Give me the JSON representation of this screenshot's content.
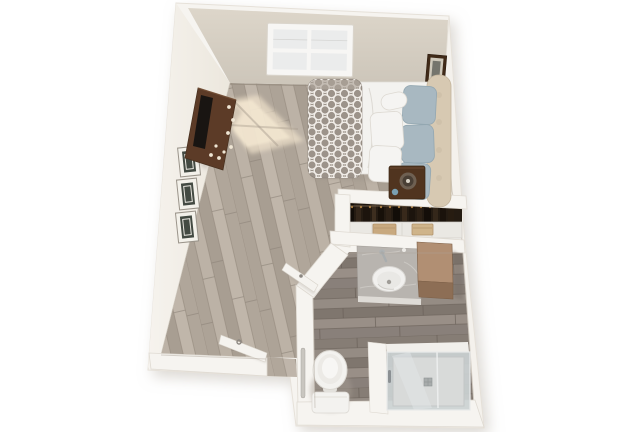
{
  "meta": {
    "kind": "3d-floor-plan-render",
    "view": "top-down",
    "background": "#ffffff"
  },
  "rooms": [
    {
      "name": "bedroom-living-area"
    },
    {
      "name": "bathroom"
    },
    {
      "name": "closet"
    }
  ],
  "objects": {
    "window": "double-hung window",
    "tv_console": "media dresser with tv",
    "gallery_frames_left": "three framed pictures",
    "gallery_frames_right": "three framed pictures",
    "bed": "bed with patterned duvet and pillows",
    "nightstand": "nightstand with lamp",
    "closet": "closet with hanging clothes, shelf and baskets",
    "vanity": "bathroom vanity with sink",
    "cabinet": "storage cabinet",
    "toilet": "toilet",
    "shower": "walk-in shower",
    "entry_door": "entry door (open)",
    "bath_door": "bathroom door (open)"
  },
  "colors": {
    "background": "#ffffff",
    "wall": "#f6f4f0",
    "wallEdge": "#e4dfd6",
    "wallShadow": "#b9b2a7",
    "wallFaceTop": "#d9d2c6",
    "wallFaceTopDark": "#c9c2b6",
    "wallFaceLeft": "#f4f1ec",
    "floorBedroom": "#b4aba0",
    "floorBathroom": "#8d847c",
    "sunlight": "#f4e8d2",
    "sunlightSoft": "#ecdfc9",
    "windowFrame": "#f7f6f4",
    "windowPane": "#ebecec",
    "console": "#5c3b27",
    "consoleEdge": "#46301e",
    "tv": "#191512",
    "knob": "#efe6d4",
    "frameLeftMat": "#f3f1ea",
    "frameLeftArt": "#434a42",
    "frameRight": "#402a18",
    "frameRightMat": "#cfc9bb",
    "frameRightArt": "#75756d",
    "mattress": "#f3f2ef",
    "sheetCrease": "#dcd9d3",
    "duvet": "#9c938a",
    "duvetPattern": "#f6f3ee",
    "headboard": "#d7c9b2",
    "pillowBlue": "#a8b8c1",
    "pillowBlueEdge": "#8fa3ad",
    "pillowWhite": "#f5f4f2",
    "nightstand": "#50341f",
    "lampOuter": "#6e6052",
    "lampInner": "#493f35",
    "lampFinial": "#d8d2c6",
    "cup": "#7aa0b2",
    "closetDark": "#241b12",
    "closetRod": "#6b5a45",
    "hanger": "#a67b42",
    "closetShelf": "#eae8e3",
    "basket": "#c8a97f",
    "basket2": "#cfb48a",
    "counter": "#b8b4af",
    "counterFront": "#dedbd6",
    "sink": "#f1f0ee",
    "sinkInner": "#e9e8e5",
    "faucet": "#aeb2b3",
    "cabinetTop": "#b18f73",
    "cabinetFront": "#8d6e55",
    "toilet": "#f3f2ef",
    "toiletSeat": "#eceae6",
    "showerGlass": "#cbd1d3",
    "showerPan": "#d8dad9",
    "showerFrame": "#f1efeb",
    "drain": "#a8acac",
    "grabBar": "#c9c6c0",
    "door": "#f5f3ef",
    "doorShadow": "#a9a199",
    "handle": "#8c8781",
    "baseboard": "#978d80"
  }
}
